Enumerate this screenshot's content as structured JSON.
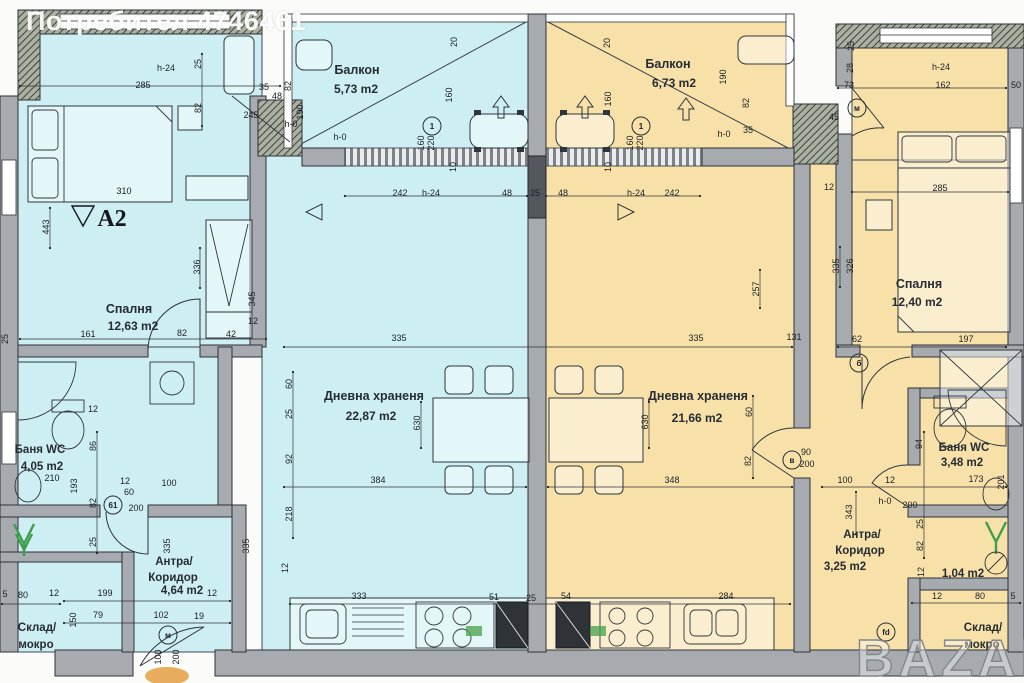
{
  "watermark": {
    "user": "Потребител 4746461",
    "brand": "BAZAR"
  },
  "unit_label": "А2",
  "colors": {
    "unit_left": "#cdeef3",
    "unit_right": "#f7e1a8",
    "wall": "#a7abaf"
  },
  "rooms": {
    "balcony_left": {
      "name": "Балкон",
      "area": "5,73 m2"
    },
    "balcony_right": {
      "name": "Балкон",
      "area": "6,73 m2"
    },
    "bedroom_left": {
      "name": "Спалня",
      "area": "12,63 m2"
    },
    "bedroom_right": {
      "name": "Спалня",
      "area": "12,40 m2"
    },
    "living_left": {
      "name": "Дневна храненя",
      "area": "22,87 m2"
    },
    "living_right": {
      "name": "Дневна храненя",
      "area": "21,66 m2"
    },
    "bath_left": {
      "name": "Баня WC",
      "area": "4,05 m2"
    },
    "bath_right": {
      "name": "Баня WC",
      "area": "3,48 m2"
    },
    "hall_left": {
      "name_line1": "Антра/",
      "name_line2": "Коридор",
      "area": "4,64 m2"
    },
    "hall_right": {
      "name_line1": "Антра/",
      "name_line2": "Коридор",
      "area": "3,25 m2"
    },
    "storage_left": {
      "name_line1": "Склад/",
      "name_line2": "мокро"
    },
    "storage_right": {
      "name_line1": "Склад/",
      "name_line2": "мокро",
      "area": "1,04 m2"
    }
  },
  "dims": [
    {
      "t": "285",
      "x": 143,
      "y": 88
    },
    {
      "t": "h-24",
      "x": 166,
      "y": 71
    },
    {
      "t": "25",
      "x": 201,
      "y": 64,
      "r": 1
    },
    {
      "t": "82",
      "x": 201,
      "y": 108,
      "r": 1
    },
    {
      "t": "35",
      "x": 264,
      "y": 90
    },
    {
      "t": "245",
      "x": 251,
      "y": 118
    },
    {
      "t": "48",
      "x": 277,
      "y": 99
    },
    {
      "t": "82",
      "x": 291,
      "y": 86,
      "r": 1
    },
    {
      "t": "190",
      "x": 303,
      "y": 112,
      "r": 1
    },
    {
      "t": "h-0",
      "x": 291,
      "y": 127
    },
    {
      "t": "h-0",
      "x": 340,
      "y": 140
    },
    {
      "t": "160",
      "x": 452,
      "y": 95,
      "r": 1
    },
    {
      "t": "20",
      "x": 457,
      "y": 42,
      "r": 1
    },
    {
      "t": "160",
      "x": 424,
      "y": 143,
      "r": 1
    },
    {
      "t": "220",
      "x": 434,
      "y": 143,
      "r": 1
    },
    {
      "t": "310",
      "x": 124,
      "y": 194
    },
    {
      "t": "443",
      "x": 49,
      "y": 227,
      "r": 1
    },
    {
      "t": "336",
      "x": 200,
      "y": 267,
      "r": 1
    },
    {
      "t": "345",
      "x": 255,
      "y": 299,
      "r": 1
    },
    {
      "t": "161",
      "x": 88,
      "y": 337
    },
    {
      "t": "82",
      "x": 182,
      "y": 336
    },
    {
      "t": "42",
      "x": 231,
      "y": 337
    },
    {
      "t": "12",
      "x": 253,
      "y": 324
    },
    {
      "t": "25",
      "x": 8,
      "y": 339,
      "r": 1
    },
    {
      "t": "242",
      "x": 400,
      "y": 196
    },
    {
      "t": "h-24",
      "x": 431,
      "y": 196
    },
    {
      "t": "48",
      "x": 507,
      "y": 196
    },
    {
      "t": "25",
      "x": 535,
      "y": 196
    },
    {
      "t": "48",
      "x": 563,
      "y": 196
    },
    {
      "t": "h-24",
      "x": 636,
      "y": 196
    },
    {
      "t": "242",
      "x": 672,
      "y": 196
    },
    {
      "t": "10",
      "x": 456,
      "y": 167,
      "r": 1
    },
    {
      "t": "10",
      "x": 611,
      "y": 167,
      "r": 1
    },
    {
      "t": "20",
      "x": 610,
      "y": 43,
      "r": 1
    },
    {
      "t": "160",
      "x": 611,
      "y": 99,
      "r": 1
    },
    {
      "t": "160",
      "x": 633,
      "y": 143,
      "r": 1
    },
    {
      "t": "220",
      "x": 643,
      "y": 143,
      "r": 1
    },
    {
      "t": "190",
      "x": 726,
      "y": 77,
      "r": 1
    },
    {
      "t": "82",
      "x": 749,
      "y": 103,
      "r": 1
    },
    {
      "t": "35",
      "x": 748,
      "y": 133
    },
    {
      "t": "h-0",
      "x": 724,
      "y": 137
    },
    {
      "t": "60",
      "x": 292,
      "y": 384,
      "r": 1
    },
    {
      "t": "25",
      "x": 292,
      "y": 414,
      "r": 1
    },
    {
      "t": "92",
      "x": 292,
      "y": 459,
      "r": 1
    },
    {
      "t": "218",
      "x": 292,
      "y": 514,
      "r": 1
    },
    {
      "t": "630",
      "x": 420,
      "y": 423,
      "r": 1
    },
    {
      "t": "384",
      "x": 378,
      "y": 483
    },
    {
      "t": "335",
      "x": 399,
      "y": 341
    },
    {
      "t": "335",
      "x": 696,
      "y": 341
    },
    {
      "t": "630",
      "x": 648,
      "y": 422,
      "r": 1
    },
    {
      "t": "348",
      "x": 672,
      "y": 483
    },
    {
      "t": "60",
      "x": 752,
      "y": 412,
      "r": 1
    },
    {
      "t": "82",
      "x": 751,
      "y": 461,
      "r": 1
    },
    {
      "t": "90",
      "x": 806,
      "y": 455
    },
    {
      "t": "200",
      "x": 807,
      "y": 467
    },
    {
      "t": "257",
      "x": 759,
      "y": 289,
      "r": 1
    },
    {
      "t": "335",
      "x": 839,
      "y": 266,
      "r": 1
    },
    {
      "t": "326",
      "x": 853,
      "y": 266,
      "r": 1
    },
    {
      "t": "131",
      "x": 794,
      "y": 340
    },
    {
      "t": "62",
      "x": 857,
      "y": 342
    },
    {
      "t": "197",
      "x": 966,
      "y": 342
    },
    {
      "t": "285",
      "x": 940,
      "y": 191
    },
    {
      "t": "73",
      "x": 849,
      "y": 88
    },
    {
      "t": "162",
      "x": 943,
      "y": 88
    },
    {
      "t": "50",
      "x": 1016,
      "y": 88
    },
    {
      "t": "h-24",
      "x": 941,
      "y": 70
    },
    {
      "t": "25",
      "x": 854,
      "y": 46,
      "r": 1
    },
    {
      "t": "28",
      "x": 853,
      "y": 68,
      "r": 1
    },
    {
      "t": "45",
      "x": 834,
      "y": 120
    },
    {
      "t": "12",
      "x": 829,
      "y": 190
    },
    {
      "t": "94",
      "x": 922,
      "y": 444,
      "r": 1
    },
    {
      "t": "100",
      "x": 845,
      "y": 483
    },
    {
      "t": "12",
      "x": 890,
      "y": 483
    },
    {
      "t": "173",
      "x": 976,
      "y": 482
    },
    {
      "t": "343",
      "x": 852,
      "y": 512,
      "r": 1
    },
    {
      "t": "25",
      "x": 923,
      "y": 524,
      "r": 1
    },
    {
      "t": "82",
      "x": 923,
      "y": 546,
      "r": 1
    },
    {
      "t": "200",
      "x": 910,
      "y": 508
    },
    {
      "t": "h-0",
      "x": 885,
      "y": 504
    },
    {
      "t": "201",
      "x": 1004,
      "y": 482,
      "r": 1
    },
    {
      "t": "12",
      "x": 924,
      "y": 572,
      "r": 1
    },
    {
      "t": "12",
      "x": 937,
      "y": 599
    },
    {
      "t": "80",
      "x": 980,
      "y": 599
    },
    {
      "t": "5",
      "x": 1013,
      "y": 599
    },
    {
      "t": "210",
      "x": 52,
      "y": 481
    },
    {
      "t": "193",
      "x": 77,
      "y": 486,
      "r": 1
    },
    {
      "t": "86",
      "x": 96,
      "y": 446,
      "r": 1
    },
    {
      "t": "82",
      "x": 96,
      "y": 503,
      "r": 1
    },
    {
      "t": "25",
      "x": 96,
      "y": 542,
      "r": 1
    },
    {
      "t": "12",
      "x": 93,
      "y": 412
    },
    {
      "t": "100",
      "x": 169,
      "y": 486
    },
    {
      "t": "60",
      "x": 129,
      "y": 495
    },
    {
      "t": "200",
      "x": 136,
      "y": 511
    },
    {
      "t": "12",
      "x": 125,
      "y": 484
    },
    {
      "t": "199",
      "x": 105,
      "y": 596
    },
    {
      "t": "12",
      "x": 212,
      "y": 596
    },
    {
      "t": "79",
      "x": 98,
      "y": 618
    },
    {
      "t": "102",
      "x": 161,
      "y": 618
    },
    {
      "t": "19",
      "x": 199,
      "y": 619
    },
    {
      "t": "100",
      "x": 161,
      "y": 657,
      "r": 1
    },
    {
      "t": "200",
      "x": 179,
      "y": 657,
      "r": 1
    },
    {
      "t": "5",
      "x": 5,
      "y": 597
    },
    {
      "t": "80",
      "x": 23,
      "y": 598
    },
    {
      "t": "12",
      "x": 54,
      "y": 596
    },
    {
      "t": "150",
      "x": 76,
      "y": 620,
      "r": 1
    },
    {
      "t": "333",
      "x": 359,
      "y": 599
    },
    {
      "t": "51",
      "x": 494,
      "y": 600
    },
    {
      "t": "25",
      "x": 531,
      "y": 601
    },
    {
      "t": "54",
      "x": 566,
      "y": 599
    },
    {
      "t": "284",
      "x": 726,
      "y": 599
    },
    {
      "t": "12",
      "x": 288,
      "y": 568,
      "r": 1
    },
    {
      "t": "335",
      "x": 170,
      "y": 546,
      "r": 1
    },
    {
      "t": "335",
      "x": 249,
      "y": 546,
      "r": 1
    }
  ],
  "markers": [
    {
      "t": "1",
      "x": 432,
      "y": 126
    },
    {
      "t": "1",
      "x": 641,
      "y": 126
    },
    {
      "t": "61",
      "x": 113,
      "y": 505
    },
    {
      "t": "м",
      "x": 168,
      "y": 635
    },
    {
      "t": "в",
      "x": 792,
      "y": 460
    },
    {
      "t": "б",
      "x": 859,
      "y": 363
    },
    {
      "t": "м",
      "x": 857,
      "y": 108
    },
    {
      "t": "fd",
      "x": 886,
      "y": 632
    }
  ]
}
